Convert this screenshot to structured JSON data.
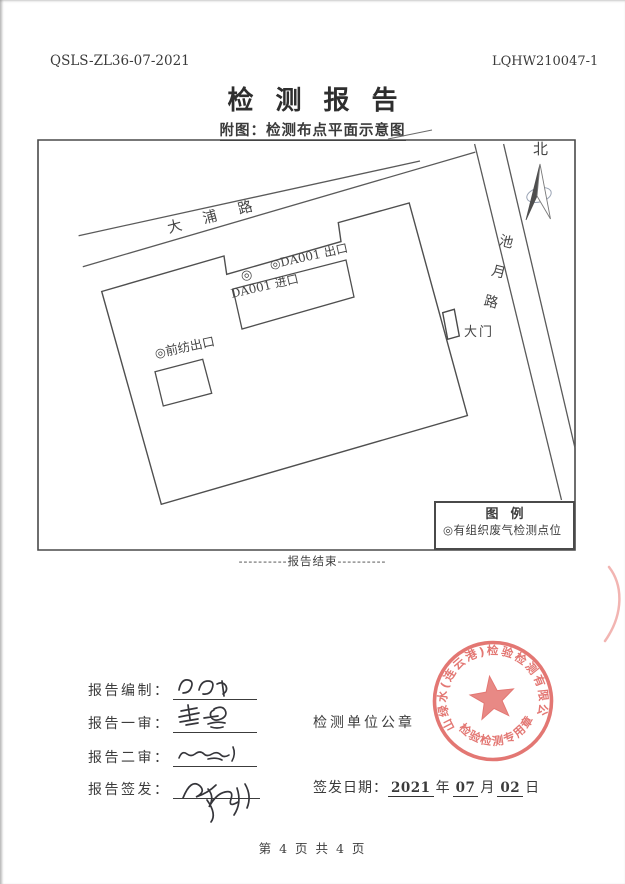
{
  "header": {
    "doc_code": "QSLS-ZL36-07-2021",
    "report_no": "LQHW210047-1",
    "title": "检测报告",
    "figure_caption": "附图：检测布点平面示意图"
  },
  "diagram": {
    "north_label": "北",
    "road_top": "大浦路",
    "road_right": "池月路",
    "point_marker": "◎",
    "label_da001_outlet": "◎DA001 出口",
    "label_da001_inlet": "DA001 进口",
    "label_qianfang_outlet": "◎前纺出口",
    "label_gate": "大门",
    "legend_title": "图例",
    "legend_item": "◎有组织废气检测点位"
  },
  "report_end_marker": "----------报告结束----------",
  "signoff": {
    "rows": [
      {
        "label": "报告编制：",
        "signature": "张杰（手写签名）"
      },
      {
        "label": "报告一审：",
        "signature": "黄一鑫（手写签名）"
      },
      {
        "label": "报告二审：",
        "signature": "手写签名"
      },
      {
        "label": "报告签发：",
        "signature": "李晓峰（手写签名）"
      }
    ],
    "seal_caption": "检测单位公章"
  },
  "seal": {
    "ring_text": "青山绿水(连云港)检验检测有限公司",
    "bottom_text": "检验检测专用章",
    "color": "#dd5a55"
  },
  "issue_date": {
    "label": "签发日期：",
    "year": "2021",
    "year_suffix": "年",
    "month": "07",
    "month_suffix": "月",
    "day": "02",
    "day_suffix": "日"
  },
  "footer": {
    "page_indicator": "第 4 页 共 4 页"
  }
}
